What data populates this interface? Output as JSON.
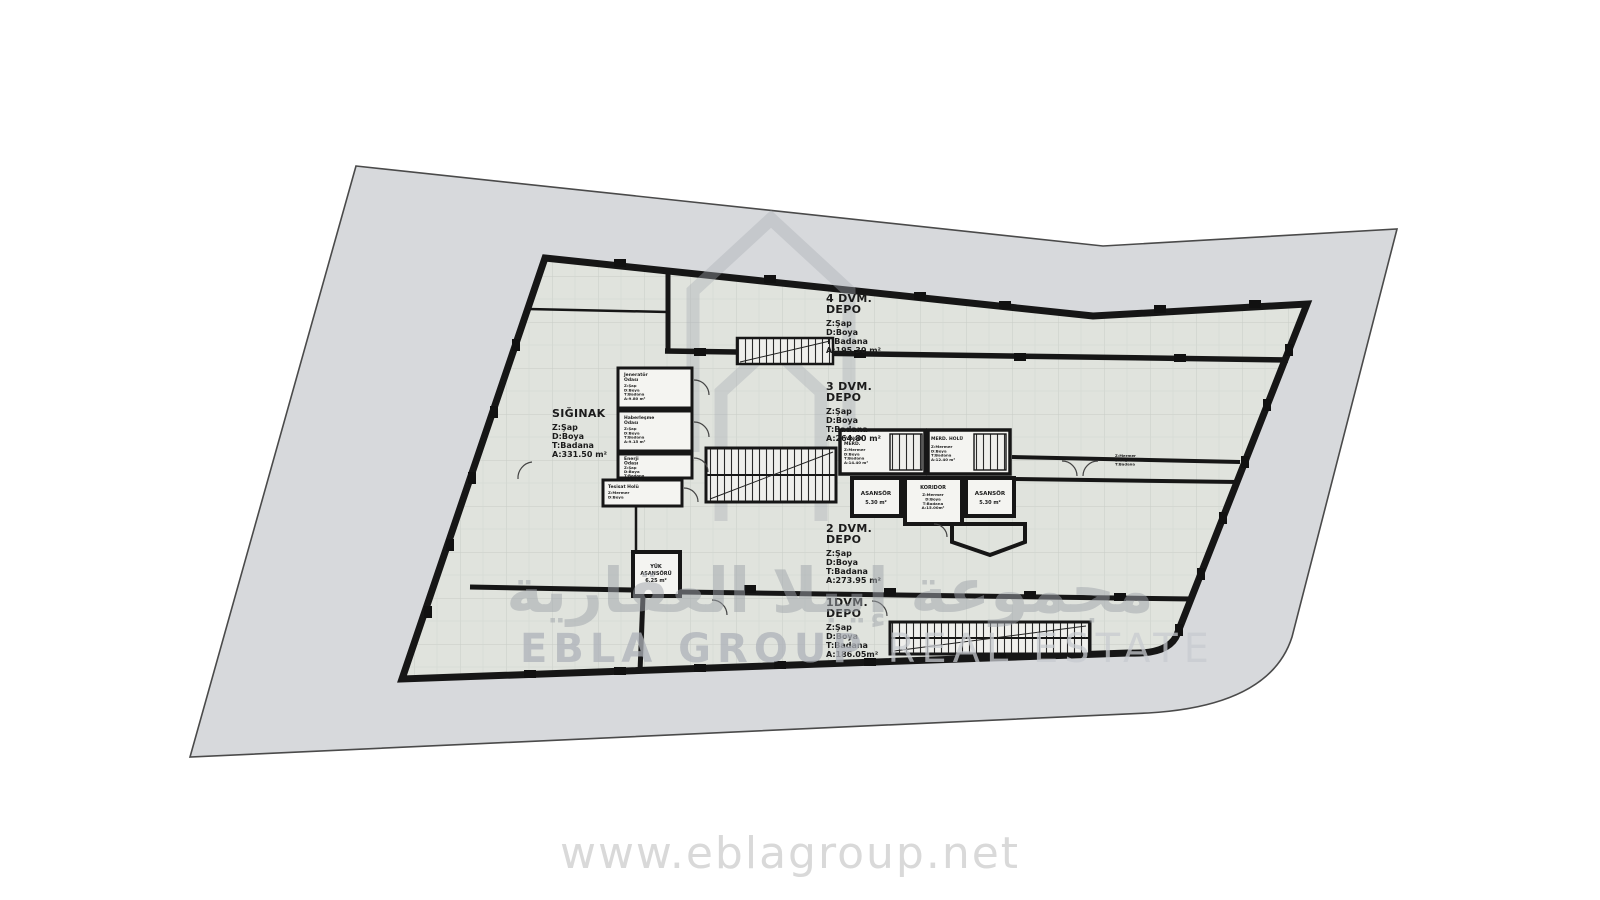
{
  "watermark": {
    "arabic": "مجموعة إيبلا العقارية",
    "english_bold": "EBLA GROUP ",
    "english_light": "REAL ESTATE",
    "url": "www.eblagroup.net"
  },
  "plan": {
    "colors": {
      "site": "#d7d9dc",
      "site_border": "#4a4a4a",
      "wall": "#161616",
      "room": "#f4f4f1",
      "floor_tile": "#e0e3dd"
    },
    "zones": {
      "depo4": {
        "title_lines": [
          "4 DVM.",
          "DEPO"
        ],
        "specs": [
          "Z:Şap",
          "D:Boya",
          "T:Badana",
          "A:195.30 m²"
        ]
      },
      "depo3": {
        "title_lines": [
          "3 DVM.",
          "DEPO"
        ],
        "specs": [
          "Z:Şap",
          "D:Boya",
          "T:Badana",
          "A:264.80 m²"
        ]
      },
      "depo2": {
        "title_lines": [
          "2 DVM.",
          "DEPO"
        ],
        "specs": [
          "Z:Şap",
          "D:Boya",
          "T:Badana",
          "A:273.95 m²"
        ]
      },
      "depo1": {
        "title_lines": [
          "1DVM.",
          "DEPO"
        ],
        "specs": [
          "Z:Şap",
          "D:Boya",
          "T:Badana",
          "A:186.05m²"
        ]
      },
      "siginak": {
        "title_lines": [
          "SIĞINAK"
        ],
        "specs": [
          "Z:Şap",
          "D:Boya",
          "T:Badana",
          "A:331.50 m²"
        ]
      }
    },
    "rooms": {
      "jenerator": {
        "name": [
          "Jeneratör",
          "Odası"
        ],
        "specs": [
          "Z:Şap",
          "D:Boya",
          "T:Badana",
          "A:9.80 m²"
        ]
      },
      "haberlesme": {
        "name": [
          "Haberleşme",
          "Odası"
        ],
        "specs": [
          "Z:Şap",
          "D:Boya",
          "T:Badana",
          "A:9.15 m²"
        ]
      },
      "enerji": {
        "name": [
          "Enerji",
          "Odası"
        ],
        "specs": [
          "Z:Şap",
          "D:Boya",
          "T:Badana",
          "A:9.15 m²"
        ]
      },
      "tesisat": {
        "name": [
          "Tesisat Holü"
        ],
        "specs": [
          "Z:Mermer",
          "D:Boya"
        ]
      },
      "yangin": {
        "name": [
          "YANGIN",
          "MERD."
        ],
        "specs": [
          "Z:Mermer",
          "D:Boya",
          "T:Badana",
          "A:14.40 m²"
        ]
      },
      "merdhol": {
        "name": [
          "MERD. HOLÜ"
        ],
        "specs": [
          "Z:Mermer",
          "D:Boya",
          "T:Badana",
          "A:12.40 m²"
        ]
      },
      "asansor_sol": {
        "name": [
          "ASANSÖR"
        ],
        "specs": [
          "5.30 m²"
        ]
      },
      "koridor": {
        "name": [
          "KORIDOR"
        ],
        "specs": [
          "Z:Mermer",
          "D:Boya",
          "T:Badana",
          "A:15.00m²"
        ]
      },
      "asansor_sag": {
        "name": [
          "ASANSÖR"
        ],
        "specs": [
          "5.30 m²"
        ]
      },
      "yuk_asansoru": {
        "name": [
          "YÜK",
          "ASANSÖRÜ",
          "6.25 m²"
        ],
        "specs": []
      },
      "oda_sag": {
        "name": [],
        "specs": [
          "Z:Mermer",
          "D:Boya",
          "T:Badana"
        ]
      }
    }
  }
}
